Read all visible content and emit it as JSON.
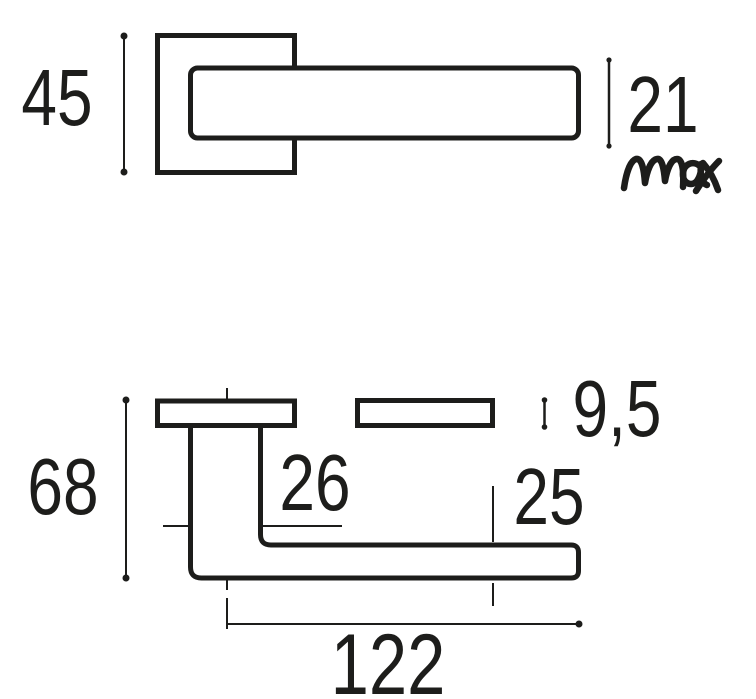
{
  "colors": {
    "background": "#ffffff",
    "ink": "#1d1d1b"
  },
  "drawing_type": "door-lever-handle-dimension-drawing",
  "front_view": {
    "rosette_size_label": "45",
    "lever_thickness_label": "21",
    "lever_thickness_qualifier": "max"
  },
  "side_view": {
    "projection_label": "68",
    "neck_width_label": "26",
    "rosette_thickness_label": "9,5",
    "end_clearance_label": "25",
    "lever_length_label": "122"
  }
}
